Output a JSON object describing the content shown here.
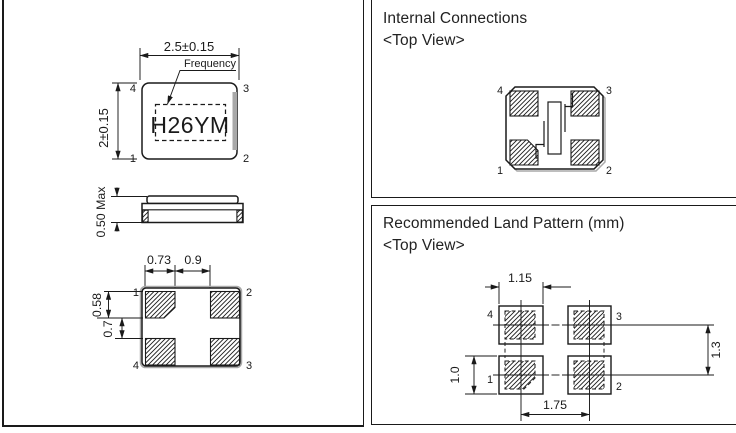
{
  "colors": {
    "line": "#1a1a1a",
    "gray": "#a9a9a9"
  },
  "drawings": {
    "top_view": {
      "dim_width": "2.5±0.15",
      "dim_height": "2±0.15",
      "frequency_label": "Frequency",
      "marking": "H26YM",
      "pin_top_left": "4",
      "pin_top_right": "3",
      "pin_bottom_left": "1",
      "pin_bottom_right": "2"
    },
    "side_view": {
      "dim_height": "0.50 Max"
    },
    "bottom_view": {
      "dim_pad_width": "0.73",
      "dim_pad_spacing": "0.9",
      "dim_pad_height": "0.58",
      "dim_row_gap": "0.7",
      "pin_top_left": "1",
      "pin_top_right": "2",
      "pin_bottom_left": "4",
      "pin_bottom_right": "3"
    }
  },
  "panels": {
    "internal_connections": {
      "title": "Internal Connections",
      "subtitle": "<Top View>",
      "pin_top_left": "4",
      "pin_top_right": "3",
      "pin_bottom_left": "1",
      "pin_bottom_right": "2"
    },
    "land_pattern": {
      "title": "Recommended Land Pattern (mm)",
      "subtitle": "<Top View>",
      "dim_pad_width": "1.15",
      "dim_row_pitch": "1.3",
      "dim_pad_height": "1.0",
      "dim_col_pitch": "1.75",
      "pin_top_left": "4",
      "pin_top_right": "3",
      "pin_bottom_left": "1",
      "pin_bottom_right": "2"
    }
  }
}
